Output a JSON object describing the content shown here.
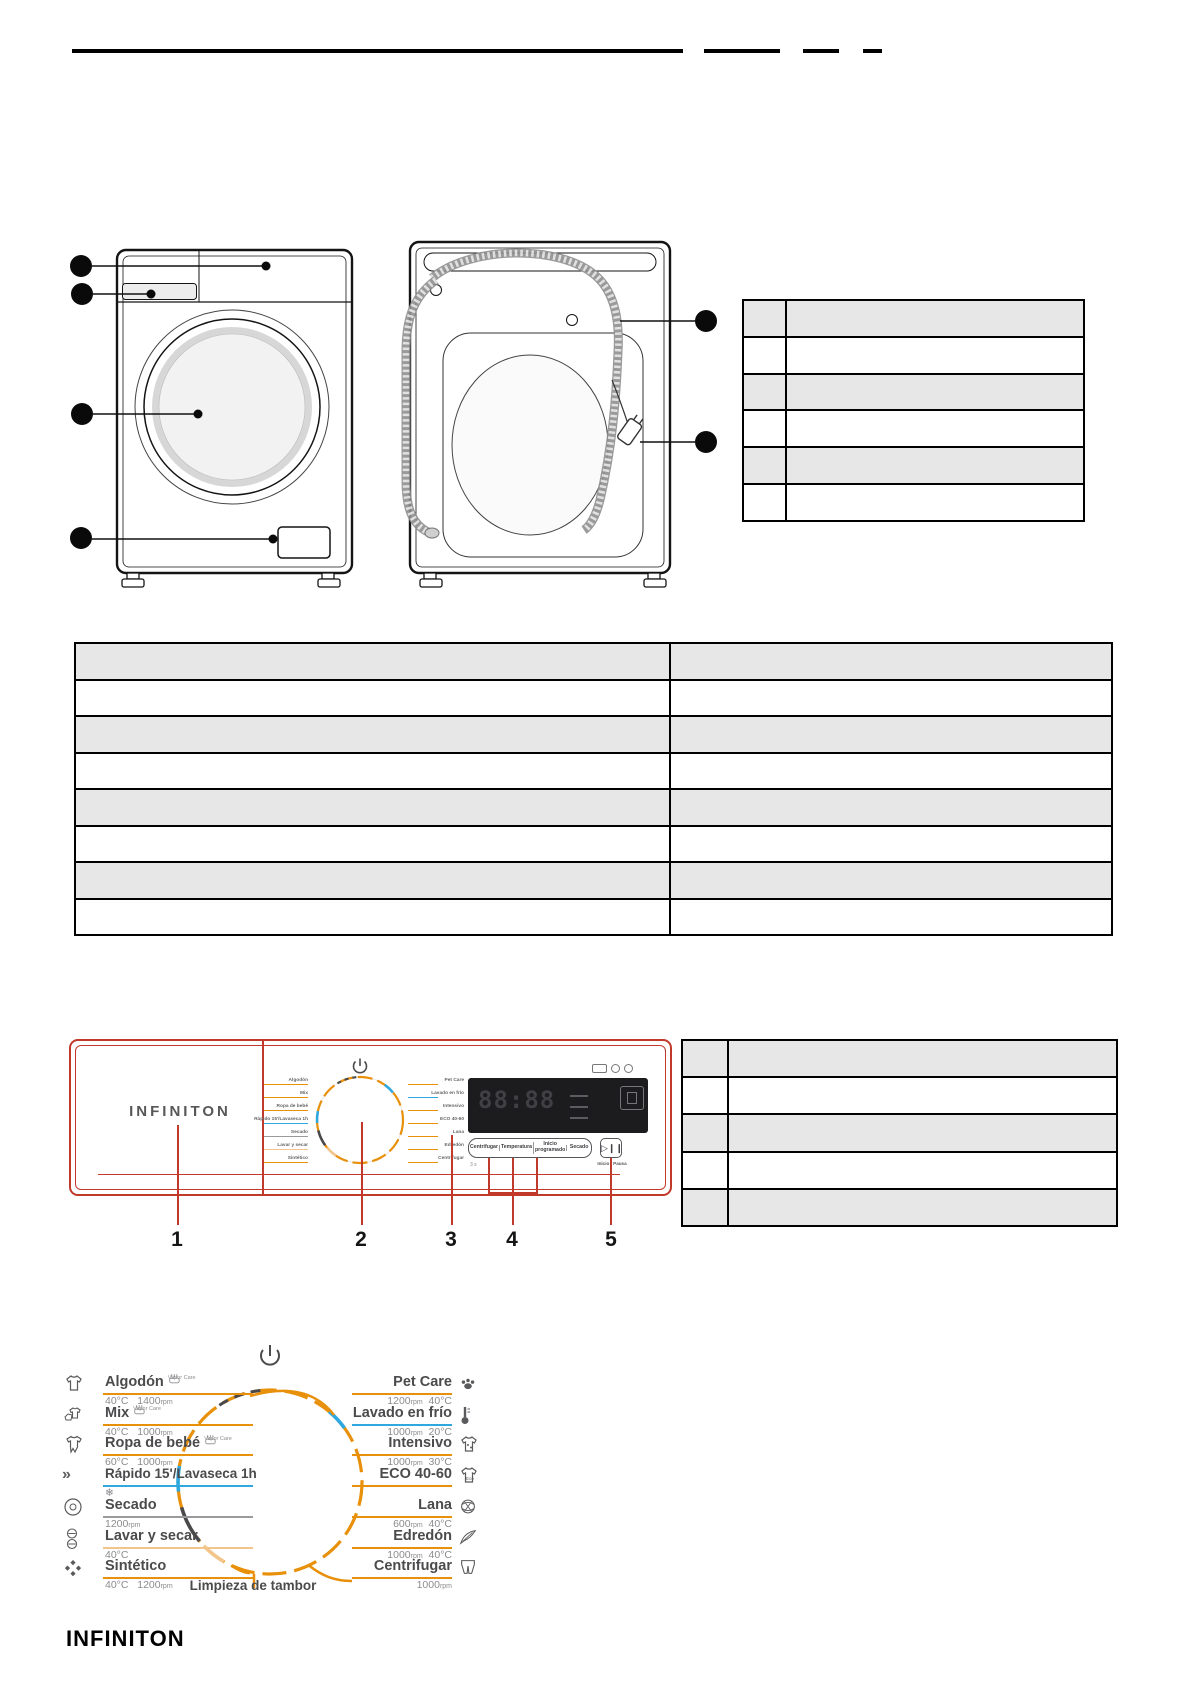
{
  "colors": {
    "accent_red": "#C0392B",
    "orange": "#E8900A",
    "blue": "#2FA8E0",
    "light_orange": "#F2C58A",
    "gray_line": "#9A9A9D",
    "dark_text": "#4B4B4D"
  },
  "tables": {
    "back_view_table_rows": 6,
    "spec_table_rows": 8,
    "panel_table_rows": 5,
    "cells_empty": true
  },
  "panel": {
    "brand": "INFINITON",
    "display_digits": "88:88",
    "buttons": [
      "Centrifugar",
      "Temperatura",
      "Inicio programado",
      "Secado"
    ],
    "start_button_icon": "play-pause-icon",
    "start_button_label": "Inicio / Pausa",
    "note": "3 s",
    "callouts": [
      "1",
      "2",
      "3",
      "4",
      "5"
    ]
  },
  "dial": {
    "center_label": "Limpieza de tambor",
    "power_icon": "power-icon",
    "left": [
      {
        "name": "Algodón",
        "icon": "tshirt",
        "extra": "Vapor Care",
        "temp": "40°C",
        "spin": "1400",
        "unit": "rpm",
        "color": "#E8900A"
      },
      {
        "name": "Mix",
        "icon": "mixed-garments",
        "extra": "Vapor Care",
        "temp": "40°C",
        "spin": "1000",
        "unit": "rpm",
        "color": "#E8900A"
      },
      {
        "name": "Ropa de bebé",
        "icon": "baby-onesie",
        "extra": "Vapor Care",
        "temp": "60°C",
        "spin": "1000",
        "unit": "rpm",
        "color": "#E8900A"
      },
      {
        "name": "Rápido 15'/Lavaseca 1h",
        "icon": "fast-forward",
        "snowflake": "❄",
        "color": "#2FA8E0"
      },
      {
        "name": "Secado",
        "icon": "drum",
        "spin": "1200",
        "unit": "rpm",
        "color": "#9A9A9D"
      },
      {
        "name": "Lavar y secar",
        "icon": "wash-dry",
        "temp": "40°C",
        "color": "#F2C58A"
      },
      {
        "name": "Sintético",
        "icon": "knit",
        "temp": "40°C",
        "spin": "1200",
        "unit": "rpm",
        "color": "#E8900A"
      }
    ],
    "right": [
      {
        "name": "Pet Care",
        "icon": "paw",
        "spin": "1200",
        "unit": "rpm",
        "temp": "40°C",
        "color": "#E8900A"
      },
      {
        "name": "Lavado en frío",
        "icon": "thermometer",
        "spin": "1000",
        "unit": "rpm",
        "temp": "20°C",
        "color": "#2FA8E0"
      },
      {
        "name": "Intensivo",
        "icon": "stained-shirt",
        "spin": "1000",
        "unit": "rpm",
        "temp": "30°C",
        "color": "#E8900A"
      },
      {
        "name": "ECO 40-60",
        "icon": "eco-shirt",
        "color": "#E8900A"
      },
      {
        "name": "Lana",
        "icon": "wool",
        "spin": "600",
        "unit": "rpm",
        "temp": "40°C",
        "color": "#E8900A"
      },
      {
        "name": "Edredón",
        "icon": "feather",
        "spin": "1000",
        "unit": "rpm",
        "temp": "40°C",
        "color": "#E8900A"
      },
      {
        "name": "Centrifugar",
        "icon": "trousers",
        "spin": "1000",
        "unit": "rpm",
        "color": "#E8900A"
      }
    ]
  },
  "footer": {
    "brand": "INFINITON"
  }
}
